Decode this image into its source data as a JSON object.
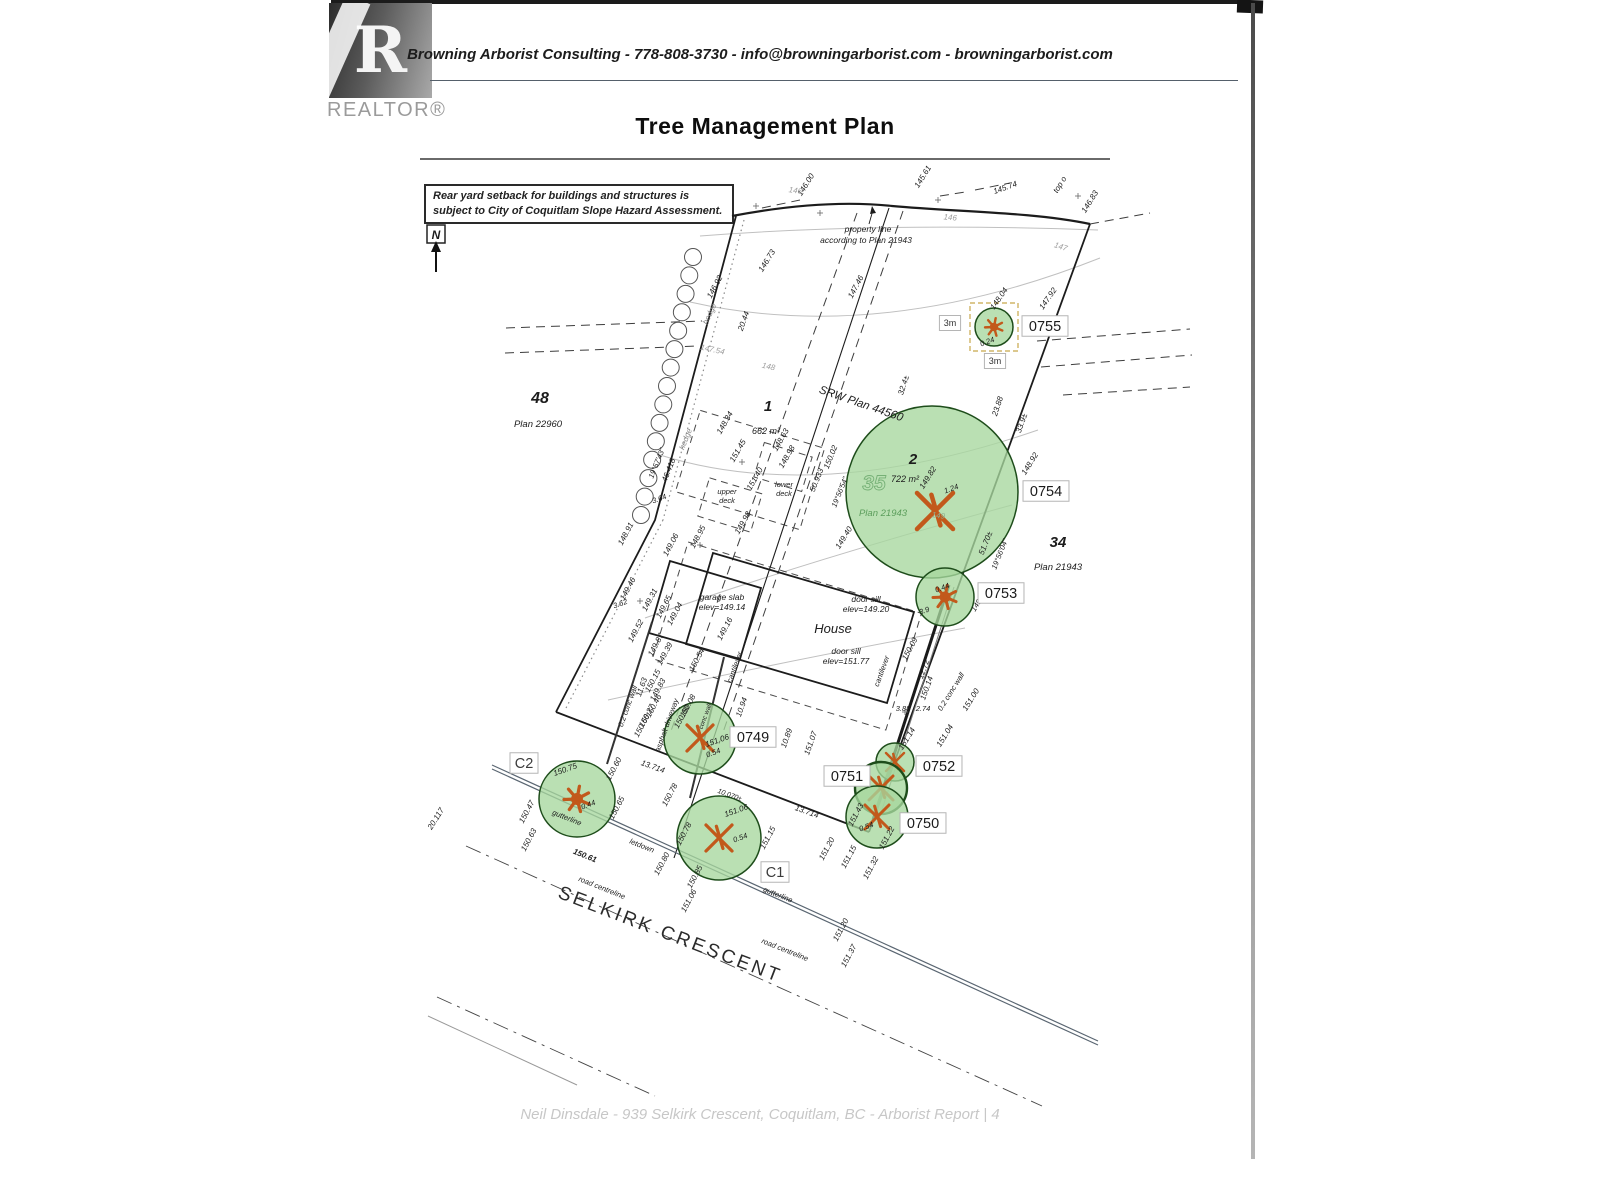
{
  "header": {
    "logo_letter": "R",
    "logo_text": "REALTOR®",
    "contact_line": "Browning Arborist Consulting - 778-808-3730 - info@browningarborist.com - browningarborist.com",
    "title": "Tree Management Plan"
  },
  "note_box": {
    "line1": "Rear yard setback for buildings and structures is",
    "line2": "subject to City of Coquitlam Slope Hazard Assessment."
  },
  "north": {
    "label": "N"
  },
  "footer": {
    "text": "Neil Dinsdale - 939 Selkirk Crescent, Coquitlam, BC - Arborist Report | 4"
  },
  "colors": {
    "ink": "#1c1c1c",
    "gray": "#9d9d9d",
    "contour": "#c0c0c0",
    "tree_fill": "#a6d79e",
    "tree_stroke": "#1e4d1b",
    "symbol": "#c2591b",
    "green_text": "#5c9e5c",
    "tag_border": "#b5b5b5",
    "accent_dash": "#c8a84b",
    "road": "#5a6672"
  },
  "lots": [
    {
      "id": "48",
      "idx": 540,
      "idy": 403,
      "ids": 16,
      "plan": "Plan 22960",
      "px": 538,
      "py": 427
    },
    {
      "id": "1",
      "idx": 768,
      "idy": 411,
      "ids": 15,
      "area": "662 m²",
      "ax": 766,
      "ay": 434
    },
    {
      "id": "2",
      "idx": 913,
      "idy": 464,
      "ids": 15,
      "area": "722 m²",
      "ax": 905,
      "ay": 482,
      "wm": "35",
      "wx": 874,
      "wy": 490,
      "plan": "Plan 21943",
      "px": 883,
      "py": 516,
      "pc": "green"
    },
    {
      "id": "34",
      "idx": 1058,
      "idy": 547,
      "ids": 15,
      "plan": "Plan 21943",
      "px": 1058,
      "py": 570
    }
  ],
  "trees": [
    {
      "id": "0755",
      "cx": 994,
      "cy": 327,
      "r": 19,
      "sym": "star",
      "ss": 9,
      "sq": 1
    },
    {
      "id": "0754",
      "cx": 932,
      "cy": 492,
      "r": 86,
      "sym": "x",
      "ss": 18,
      "sx": 935,
      "sy": 511
    },
    {
      "id": "0753",
      "cx": 945,
      "cy": 597,
      "r": 29,
      "sym": "star",
      "ss": 12
    },
    {
      "id": "0749",
      "cx": 700,
      "cy": 738,
      "r": 36,
      "sym": "x",
      "ss": 13
    },
    {
      "id": "0752",
      "cx": 895,
      "cy": 762,
      "r": 19,
      "sym": "x",
      "ss": 9
    },
    {
      "id": "0751",
      "cx": 881,
      "cy": 788,
      "r": 26,
      "sym": "x",
      "ss": 12,
      "bold": 1
    },
    {
      "id": "0750",
      "cx": 877,
      "cy": 817,
      "r": 31,
      "sym": "x",
      "ss": 12
    },
    {
      "id": "C2",
      "cx": 577,
      "cy": 799,
      "r": 38,
      "sym": "star",
      "ss": 13
    },
    {
      "id": "C1",
      "cx": 719,
      "cy": 838,
      "r": 42,
      "sym": "x",
      "ss": 13
    }
  ],
  "tags": [
    {
      "t": "0755",
      "x": 1045,
      "y": 326
    },
    {
      "t": "0754",
      "x": 1046,
      "y": 491
    },
    {
      "t": "0753",
      "x": 1001,
      "y": 593
    },
    {
      "t": "0749",
      "x": 753,
      "y": 737
    },
    {
      "t": "0752",
      "x": 939,
      "y": 766
    },
    {
      "t": "0751",
      "x": 847,
      "y": 776
    },
    {
      "t": "0750",
      "x": 923,
      "y": 823
    },
    {
      "t": "C1",
      "x": 775,
      "y": 872,
      "c": "#3c3c3c"
    },
    {
      "t": "C2",
      "x": 524,
      "y": 763,
      "c": "#3c3c3c"
    }
  ],
  "m3_boxes": [
    {
      "t": "3m",
      "x": 950,
      "y": 323
    },
    {
      "t": "3m",
      "x": 995,
      "y": 361
    }
  ],
  "annotations": [
    {
      "t": "146.00",
      "x": 808,
      "y": 186,
      "r": -58
    },
    {
      "t": "145.61",
      "x": 925,
      "y": 178,
      "r": -58
    },
    {
      "t": "145.74",
      "x": 1006,
      "y": 190,
      "r": -20
    },
    {
      "t": "top o",
      "x": 1062,
      "y": 186,
      "r": -58
    },
    {
      "t": "146.83",
      "x": 1092,
      "y": 203,
      "r": -58
    },
    {
      "t": "146",
      "x": 795,
      "y": 193,
      "r": 8,
      "c": "#9d9d9d"
    },
    {
      "t": "146",
      "x": 950,
      "y": 220,
      "r": 5,
      "c": "#9d9d9d"
    },
    {
      "t": "147",
      "x": 1060,
      "y": 249,
      "r": 18,
      "c": "#9d9d9d"
    },
    {
      "t": "property line",
      "x": 868,
      "y": 232,
      "s": 8.5
    },
    {
      "t": "according to Plan 21943",
      "x": 866,
      "y": 243,
      "s": 8.5
    },
    {
      "t": "146.92",
      "x": 717,
      "y": 288,
      "r": -62
    },
    {
      "t": "146.73",
      "x": 769,
      "y": 262,
      "r": -58
    },
    {
      "t": "147.46",
      "x": 858,
      "y": 288,
      "r": -62
    },
    {
      "t": "hedge",
      "x": 712,
      "y": 315,
      "r": -65,
      "c": "#8a8a8a"
    },
    {
      "t": "20.44",
      "x": 746,
      "y": 322,
      "r": -70
    },
    {
      "t": "147.54",
      "x": 712,
      "y": 352,
      "r": 12,
      "c": "#9d9d9d"
    },
    {
      "t": "148",
      "x": 768,
      "y": 369,
      "r": 12,
      "c": "#9d9d9d"
    },
    {
      "t": "147.92",
      "x": 1050,
      "y": 300,
      "r": -55
    },
    {
      "t": "148.04",
      "x": 1001,
      "y": 300,
      "r": -55
    },
    {
      "t": "0.24",
      "x": 988,
      "y": 344,
      "r": -20,
      "s": 7.5
    },
    {
      "t": "32.4±",
      "x": 906,
      "y": 386,
      "r": -72
    },
    {
      "t": "23.88",
      "x": 1000,
      "y": 407,
      "r": -72
    },
    {
      "t": "33.9±",
      "x": 1024,
      "y": 424,
      "r": -70
    },
    {
      "t": "SRW Plan 44560",
      "x": 860,
      "y": 407,
      "r": 19,
      "s": 11.5
    },
    {
      "t": "148.34",
      "x": 727,
      "y": 424,
      "r": -60
    },
    {
      "t": "148.63",
      "x": 783,
      "y": 441,
      "r": -60
    },
    {
      "t": "148.98",
      "x": 789,
      "y": 458,
      "r": -60
    },
    {
      "t": "151.45",
      "x": 740,
      "y": 452,
      "r": -60
    },
    {
      "t": "150.02",
      "x": 833,
      "y": 458,
      "r": -68
    },
    {
      "t": "50.933",
      "x": 819,
      "y": 481,
      "r": -68
    },
    {
      "t": "19°56'54\"",
      "x": 842,
      "y": 493,
      "r": -68,
      "s": 7.5
    },
    {
      "t": "upper",
      "x": 727,
      "y": 494,
      "s": 7.5
    },
    {
      "t": "deck",
      "x": 727,
      "y": 503,
      "s": 7.5
    },
    {
      "t": "lower",
      "x": 784,
      "y": 487,
      "s": 7.5
    },
    {
      "t": "deck",
      "x": 784,
      "y": 496,
      "s": 7.5
    },
    {
      "t": "151.40",
      "x": 757,
      "y": 480,
      "r": -60
    },
    {
      "t": "149.98",
      "x": 745,
      "y": 524,
      "r": -60
    },
    {
      "t": "19°57'43\"",
      "x": 659,
      "y": 464,
      "r": -68,
      "s": 7.5
    },
    {
      "t": "46.418",
      "x": 671,
      "y": 471,
      "r": -68
    },
    {
      "t": "hedge",
      "x": 688,
      "y": 440,
      "r": -68,
      "c": "#8a8a8a"
    },
    {
      "t": "3.64",
      "x": 660,
      "y": 501,
      "r": -20,
      "s": 7.5
    },
    {
      "t": "148.91",
      "x": 628,
      "y": 535,
      "r": -62
    },
    {
      "t": "149.06",
      "x": 673,
      "y": 546,
      "r": -62
    },
    {
      "t": "148.95",
      "x": 700,
      "y": 538,
      "r": -62
    },
    {
      "t": "3.62",
      "x": 621,
      "y": 606,
      "r": -20,
      "s": 7.5
    },
    {
      "t": "149.46",
      "x": 630,
      "y": 590,
      "r": -62
    },
    {
      "t": "149.31",
      "x": 652,
      "y": 601,
      "r": -62
    },
    {
      "t": "149.65",
      "x": 666,
      "y": 608,
      "r": -62
    },
    {
      "t": "149.04",
      "x": 677,
      "y": 615,
      "r": -62
    },
    {
      "t": "149.52",
      "x": 638,
      "y": 632,
      "r": -62
    },
    {
      "t": "149.87",
      "x": 658,
      "y": 646,
      "r": -62
    },
    {
      "t": "149.39",
      "x": 667,
      "y": 655,
      "r": -62
    },
    {
      "t": "garage slab",
      "x": 722,
      "y": 600,
      "s": 8.5
    },
    {
      "t": "elev=149.14",
      "x": 722,
      "y": 610,
      "s": 8.5
    },
    {
      "t": "149.16",
      "x": 727,
      "y": 630,
      "r": -62
    },
    {
      "t": "door sill",
      "x": 866,
      "y": 602,
      "s": 8.5
    },
    {
      "t": "elev=149.20",
      "x": 866,
      "y": 612,
      "s": 8.5
    },
    {
      "t": "House",
      "x": 833,
      "y": 633,
      "s": 13
    },
    {
      "t": "door sill",
      "x": 846,
      "y": 654,
      "s": 8.5
    },
    {
      "t": "elev=151.77",
      "x": 846,
      "y": 664,
      "s": 8.5
    },
    {
      "t": "cantilever",
      "x": 737,
      "y": 668,
      "r": -70,
      "s": 7.5
    },
    {
      "t": "cantilever",
      "x": 884,
      "y": 672,
      "r": -70,
      "s": 7.5
    },
    {
      "t": "150.54",
      "x": 699,
      "y": 661,
      "r": -62
    },
    {
      "t": "0.2 conc wall",
      "x": 630,
      "y": 707,
      "r": -70,
      "s": 7.5
    },
    {
      "t": "11.63",
      "x": 644,
      "y": 688,
      "r": -70
    },
    {
      "t": "150.15",
      "x": 655,
      "y": 682,
      "r": -62
    },
    {
      "t": "149.83",
      "x": 660,
      "y": 691,
      "r": -62
    },
    {
      "t": "150.46",
      "x": 656,
      "y": 707,
      "r": -62
    },
    {
      "t": "150.27",
      "x": 649,
      "y": 717,
      "r": -62
    },
    {
      "t": "150.66",
      "x": 644,
      "y": 727,
      "r": -62
    },
    {
      "t": "asphalt driveway",
      "x": 669,
      "y": 726,
      "r": -70,
      "s": 7.5
    },
    {
      "t": "150.08",
      "x": 690,
      "y": 707,
      "r": -62
    },
    {
      "t": "150.60",
      "x": 684,
      "y": 718,
      "r": -62
    },
    {
      "t": "conc wall",
      "x": 707,
      "y": 717,
      "r": -70,
      "s": 6.5
    },
    {
      "t": "10.94",
      "x": 744,
      "y": 708,
      "r": -70
    },
    {
      "t": "151.06",
      "x": 718,
      "y": 743,
      "r": -20
    },
    {
      "t": "0.54",
      "x": 714,
      "y": 755,
      "r": -20,
      "s": 7.5
    },
    {
      "t": "10.89",
      "x": 789,
      "y": 739,
      "r": -70
    },
    {
      "t": "151.07",
      "x": 813,
      "y": 744,
      "r": -70
    },
    {
      "t": "13.714",
      "x": 652,
      "y": 769,
      "r": 20
    },
    {
      "t": "13.714",
      "x": 806,
      "y": 814,
      "r": 20
    },
    {
      "t": "150.78",
      "x": 672,
      "y": 796,
      "r": -62
    },
    {
      "t": "150.78",
      "x": 686,
      "y": 835,
      "r": -62
    },
    {
      "t": "150.75",
      "x": 566,
      "y": 772,
      "r": -20
    },
    {
      "t": "0.44",
      "x": 589,
      "y": 807,
      "r": -20,
      "s": 7.5
    },
    {
      "t": "150.60",
      "x": 616,
      "y": 770,
      "r": -62
    },
    {
      "t": "150.65",
      "x": 619,
      "y": 809,
      "r": -62
    },
    {
      "t": "150.47",
      "x": 529,
      "y": 813,
      "r": -62
    },
    {
      "t": "gutterline",
      "x": 566,
      "y": 820,
      "r": 22,
      "s": 7.5
    },
    {
      "t": "150.63",
      "x": 531,
      "y": 841,
      "r": -62
    },
    {
      "t": "150.61",
      "x": 584,
      "y": 858,
      "r": 22,
      "w": "b"
    },
    {
      "t": "letdown",
      "x": 641,
      "y": 848,
      "r": 22,
      "s": 7.5
    },
    {
      "t": "150.80",
      "x": 664,
      "y": 865,
      "r": -62
    },
    {
      "t": "150.85",
      "x": 697,
      "y": 878,
      "r": -62
    },
    {
      "t": "151.06",
      "x": 691,
      "y": 902,
      "r": -62
    },
    {
      "t": "151.06",
      "x": 737,
      "y": 813,
      "r": -20
    },
    {
      "t": "0.54",
      "x": 741,
      "y": 840,
      "r": -20,
      "s": 7.5
    },
    {
      "t": "10.070±",
      "x": 729,
      "y": 797,
      "r": 20,
      "s": 7
    },
    {
      "t": "gutterline",
      "x": 777,
      "y": 897,
      "r": 22,
      "s": 7.5
    },
    {
      "t": "road centreline",
      "x": 601,
      "y": 890,
      "r": 22,
      "s": 7.5
    },
    {
      "t": "road centreline",
      "x": 784,
      "y": 952,
      "r": 22,
      "s": 7.5
    },
    {
      "t": "151.20",
      "x": 843,
      "y": 931,
      "r": -62
    },
    {
      "t": "151.37",
      "x": 851,
      "y": 957,
      "r": -62
    },
    {
      "t": "151.15",
      "x": 770,
      "y": 839,
      "r": -62
    },
    {
      "t": "151.15",
      "x": 851,
      "y": 858,
      "r": -62
    },
    {
      "t": "151.32",
      "x": 873,
      "y": 869,
      "r": -62
    },
    {
      "t": "151.20",
      "x": 829,
      "y": 850,
      "r": -62
    },
    {
      "t": "151.22",
      "x": 889,
      "y": 839,
      "r": -62
    },
    {
      "t": "151.04",
      "x": 947,
      "y": 737,
      "r": -58
    },
    {
      "t": "151.00",
      "x": 973,
      "y": 701,
      "r": -58
    },
    {
      "t": "0.2 conc wall",
      "x": 953,
      "y": 693,
      "r": -58,
      "s": 7.5
    },
    {
      "t": "12.72",
      "x": 926,
      "y": 670,
      "r": -70
    },
    {
      "t": "150.14",
      "x": 929,
      "y": 689,
      "r": -70
    },
    {
      "t": "3.88",
      "x": 903,
      "y": 711,
      "s": 7.5
    },
    {
      "t": "2.74",
      "x": 923,
      "y": 711,
      "s": 7.5
    },
    {
      "t": "150.09",
      "x": 912,
      "y": 650,
      "r": -62
    },
    {
      "t": "151.14",
      "x": 909,
      "y": 740,
      "r": -58
    },
    {
      "t": "151.43",
      "x": 858,
      "y": 816,
      "r": -62
    },
    {
      "t": "0.54",
      "x": 867,
      "y": 829,
      "r": -20,
      "s": 7.5
    },
    {
      "t": "0.44",
      "x": 943,
      "y": 590,
      "r": -20,
      "s": 7.5
    },
    {
      "t": "3.9",
      "x": 925,
      "y": 613,
      "r": -20,
      "s": 7.5
    },
    {
      "t": "149.1",
      "x": 980,
      "y": 604,
      "r": -58,
      "s": 7.5
    },
    {
      "t": "149.82",
      "x": 930,
      "y": 479,
      "r": -58
    },
    {
      "t": "1.24",
      "x": 952,
      "y": 491,
      "r": -20,
      "s": 7.5
    },
    {
      "t": "149",
      "x": 938,
      "y": 518,
      "r": 8,
      "c": "#8fae8f"
    },
    {
      "t": "51.70±",
      "x": 988,
      "y": 544,
      "r": -68
    },
    {
      "t": "19°56'04\"",
      "x": 1002,
      "y": 555,
      "r": -68,
      "s": 7.5
    },
    {
      "t": "148.92",
      "x": 1032,
      "y": 465,
      "r": -58
    },
    {
      "t": "149.40",
      "x": 846,
      "y": 539,
      "r": -58
    },
    {
      "t": "20.117",
      "x": 438,
      "y": 820,
      "r": -58
    },
    {
      "t": "SELKIRK CRESCENT",
      "x": 668,
      "y": 940,
      "r": 21,
      "s": 19,
      "ls": 3,
      "ni": 1,
      "c": "#2b2b2b"
    }
  ]
}
